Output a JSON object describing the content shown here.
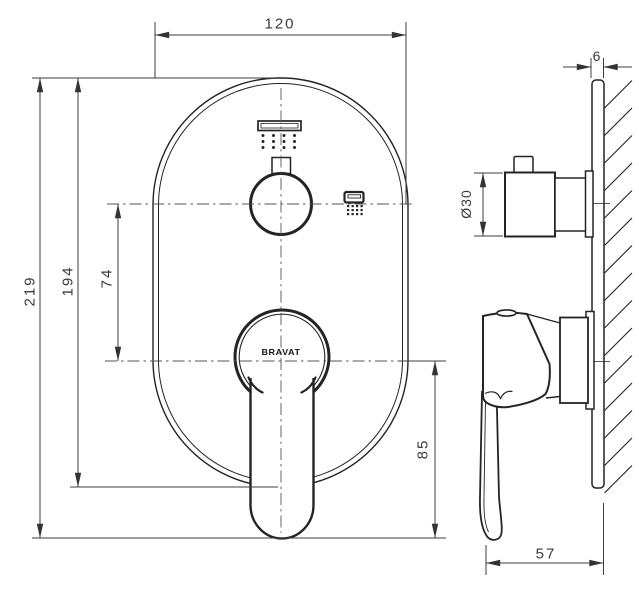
{
  "meta": {
    "type": "technical-dimension-drawing",
    "subject": "concealed shower mixer trim plate, front and side views",
    "background": "#ffffff"
  },
  "brand": {
    "logo_text": "BRAVAT"
  },
  "dimensions": {
    "plate_width": "120",
    "total_height": "219",
    "plate_height": "194",
    "knob_center_to_handle_center": "74",
    "plate_thickness": "6",
    "knob_diameter": "Ø30",
    "handle_center_to_lever_tip": "85",
    "handle_projection": "57"
  },
  "icons": {
    "rain_shower": "rain-shower-icon",
    "hand_shower": "hand-shower-icon"
  },
  "colors": {
    "line": "#242424",
    "dimension": "#3d3d3d",
    "centerline": "#555555"
  }
}
